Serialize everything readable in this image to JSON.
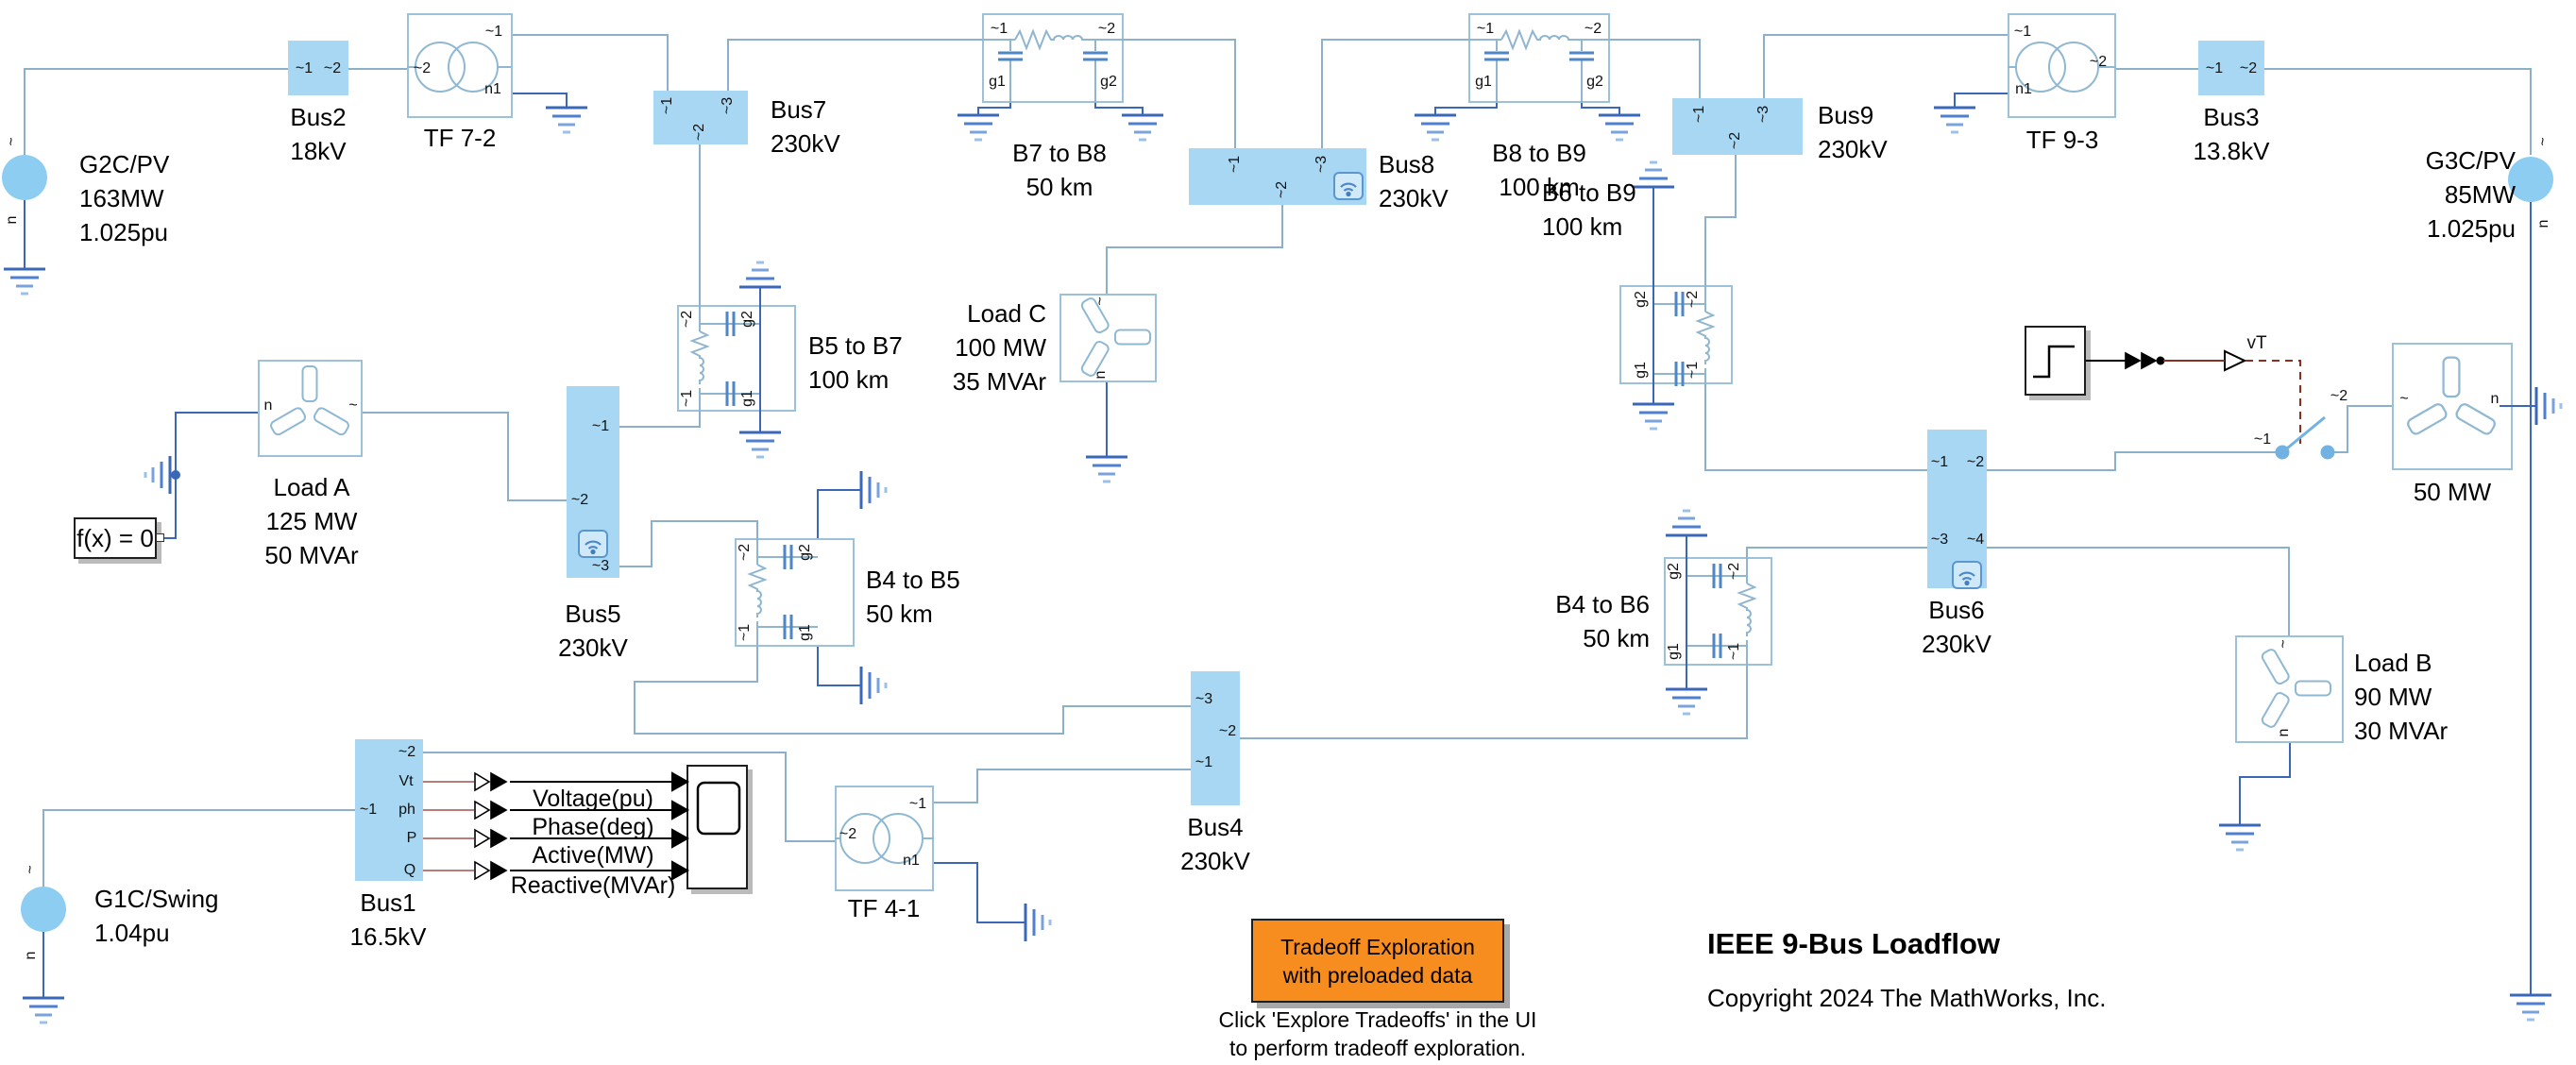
{
  "title": {
    "heading": "IEEE 9-Bus Loadflow",
    "copyright": "Copyright 2024 The MathWorks, Inc."
  },
  "annotations": {
    "button1": "Tradeoff Exploration",
    "button2": "with preloaded data",
    "note1": "Click 'Explore Tradeoffs' in the UI",
    "note2": "to perform tradeoff exploration."
  },
  "ports": {
    "t1": "~1",
    "t2": "~2",
    "t3": "~3",
    "t4": "~4",
    "g1": "g1",
    "g2": "g2",
    "ac": "~",
    "n": "n",
    "n1": "n1",
    "vt": "Vt",
    "ph": "ph",
    "p": "P",
    "q": "Q",
    "vT": "vT"
  },
  "generators": {
    "g2c": {
      "l1": "G2C/PV",
      "l2": "163MW",
      "l3": "1.025pu"
    },
    "g3c": {
      "l1": "G3C/PV",
      "l2": "85MW",
      "l3": "1.025pu"
    },
    "g1c": {
      "l1": "G1C/Swing",
      "l2": "1.04pu"
    }
  },
  "buses": {
    "bus1": {
      "name": "Bus1",
      "kv": "16.5kV"
    },
    "bus2": {
      "name": "Bus2",
      "kv": "18kV"
    },
    "bus3": {
      "name": "Bus3",
      "kv": "13.8kV"
    },
    "bus4": {
      "name": "Bus4",
      "kv": "230kV"
    },
    "bus5": {
      "name": "Bus5",
      "kv": "230kV"
    },
    "bus6": {
      "name": "Bus6",
      "kv": "230kV"
    },
    "bus7": {
      "name": "Bus7",
      "kv": "230kV"
    },
    "bus8": {
      "name": "Bus8",
      "kv": "230kV"
    },
    "bus9": {
      "name": "Bus9",
      "kv": "230kV"
    }
  },
  "transformers": {
    "tf72": "TF 7-2",
    "tf93": "TF 9-3",
    "tf41": "TF 4-1"
  },
  "lines": {
    "b7b8": {
      "name": "B7 to B8",
      "len": "50 km"
    },
    "b8b9": {
      "name": "B8 to B9",
      "len": "100 km"
    },
    "b5b7": {
      "name": "B5 to B7",
      "len": "100 km"
    },
    "b4b5": {
      "name": "B4 to B5",
      "len": "50 km"
    },
    "b6b9": {
      "name": "B6 to B9",
      "len": "100 km"
    },
    "b4b6": {
      "name": "B4 to B6",
      "len": "50 km"
    }
  },
  "loads": {
    "loadA": {
      "name": "Load A",
      "p": "125 MW",
      "q": "50 MVAr"
    },
    "loadB": {
      "name": "Load B",
      "p": "90 MW",
      "q": "30 MVAr"
    },
    "loadC": {
      "name": "Load C",
      "p": "100 MW",
      "q": "35 MVAr"
    },
    "gen50": {
      "name": "50 MW"
    }
  },
  "solver": {
    "label": "f(x) = 0"
  },
  "scope_signals": [
    "Voltage(pu)",
    "Phase(deg)",
    "Active(MW)",
    "Reactive(MVAr)"
  ],
  "colors": {
    "bus_fill": "#a8d7f3",
    "ac_wire": "#8cb0ca",
    "electrical_wire": "#3a67b8",
    "signal_wire": "#000000",
    "physical_signal": "#8b2f23",
    "physical_signal_light": "#bb7b7b",
    "block_border": "#9cc2da",
    "orange": "#f78d1e",
    "generator_fill": "#8ecdf2"
  }
}
